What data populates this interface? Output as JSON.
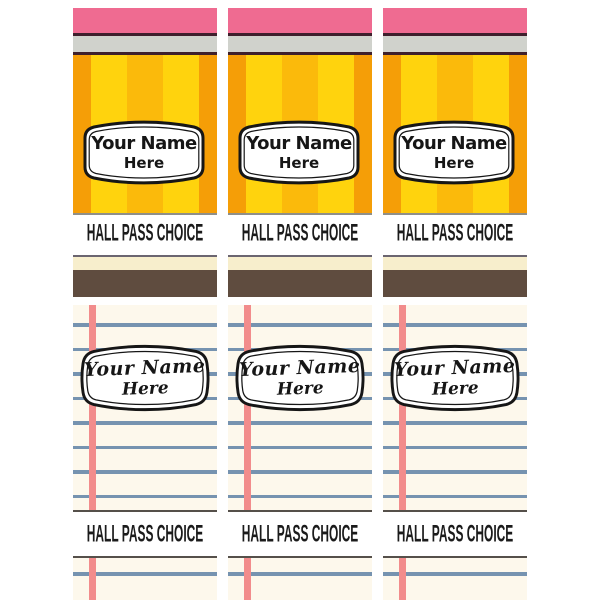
{
  "sheet": {
    "columns": 3,
    "background": "#FFFFFF"
  },
  "pencil_card": {
    "name_line1": "Your Name",
    "name_line2": "Here",
    "caption": "HALL PASS CHOICE",
    "colors": {
      "eraser": "#EF6B91",
      "trim": "#3E1F2C",
      "ferrule": "#D0D2CC",
      "stripe_yellow": "#FFD30D",
      "stripe_orange": "#F59E07",
      "stripe_amber": "#FBBA0B",
      "base_line": "#8F8F89"
    }
  },
  "divider_card": {
    "colors": {
      "cream": "#F7EECC",
      "brown": "#5F4C3F",
      "border": "#6B6570"
    }
  },
  "notebook_card": {
    "name_line1": "Your Name",
    "name_line2": "Here",
    "caption": "HALL PASS CHOICE",
    "colors": {
      "paper": "#FDF8EC",
      "rule_blue": "#7693B0",
      "margin_pink": "#F28C8C",
      "border": "#55504A"
    }
  }
}
